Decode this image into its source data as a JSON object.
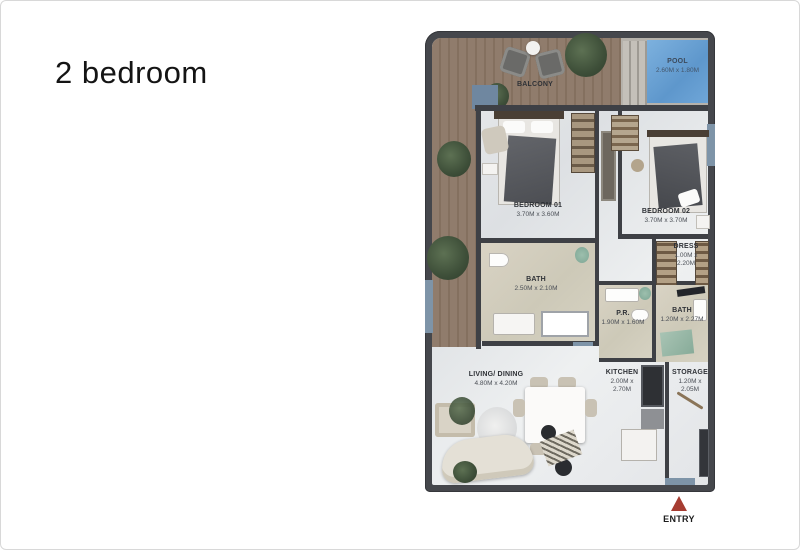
{
  "page": {
    "title": "2 bedroom"
  },
  "plan": {
    "balcony": {
      "name": "BALCONY"
    },
    "pool": {
      "name": "POOL",
      "dims": "2.60M x 1.80M"
    },
    "bedroom1": {
      "name": "BEDROOM 01",
      "dims": "3.70M x 3.60M"
    },
    "bedroom2": {
      "name": "BEDROOM 02",
      "dims": "3.70M x 3.70M"
    },
    "dress": {
      "name": "DRESS",
      "dims": "1.00M x 2.20M"
    },
    "bath1": {
      "name": "BATH",
      "dims": "2.50M x 2.10M"
    },
    "pr": {
      "name": "P.R.",
      "dims": "1.90M x 1.60M"
    },
    "bath2": {
      "name": "BATH",
      "dims": "1.20M x 2.27M"
    },
    "living": {
      "name": "LIVING/ DINING",
      "dims": "4.80M x 4.20M"
    },
    "kitchen": {
      "name": "KITCHEN",
      "dims": "2.00M x 2.70M"
    },
    "storage": {
      "name": "STORAGE",
      "dims": "1.20M x 2.05M"
    },
    "entry": {
      "label": "ENTRY"
    }
  },
  "colors": {
    "wall": "#45474c",
    "window_blue": "#7e94a8",
    "pool_blue": "#6fa6d8",
    "wood": "#8d7968",
    "bath_floor": "#d3cdbd",
    "entry_red": "#a63c31"
  }
}
